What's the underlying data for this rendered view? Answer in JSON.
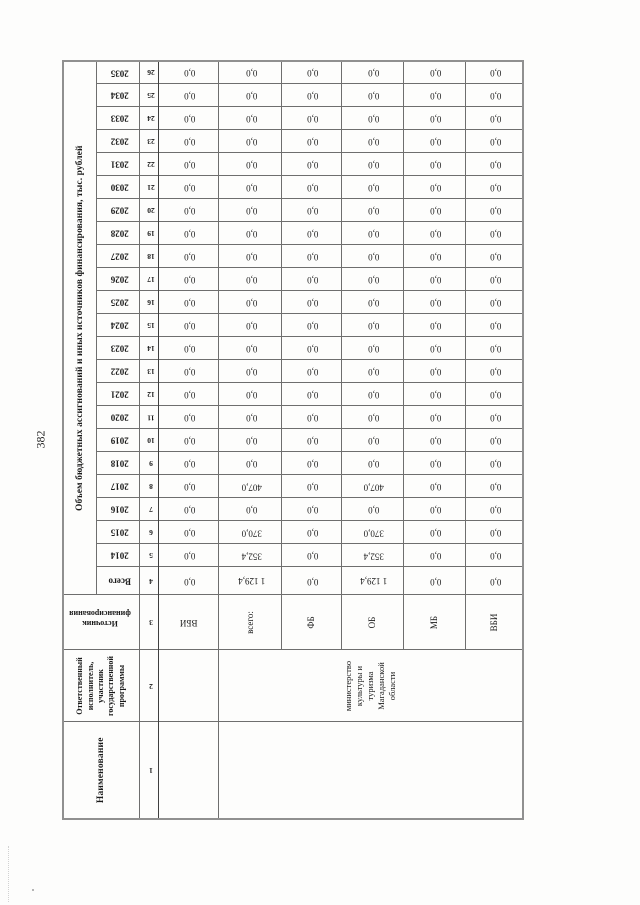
{
  "page": {
    "number": "382"
  },
  "table": {
    "headers": {
      "col1": "Наименование",
      "col2": "Ответственный\nисполнитель,\nучастник\nгосударственной\nпрограммы",
      "col3": "Источник\nфинансирования",
      "amount_span": "Объем бюджетных ассигнований и иных источников финансирования, тыс. рублей",
      "total": "Всего",
      "years": [
        "2014",
        "2015",
        "2016",
        "2017",
        "2018",
        "2019",
        "2020",
        "2021",
        "2022",
        "2023",
        "2024",
        "2025",
        "2026",
        "2027",
        "2028",
        "2029",
        "2030",
        "2031",
        "2032",
        "2033",
        "2034",
        "2035"
      ],
      "numbers": [
        "1",
        "2",
        "3",
        "4",
        "5",
        "6",
        "7",
        "8",
        "9",
        "10",
        "11",
        "12",
        "13",
        "14",
        "15",
        "16",
        "17",
        "18",
        "19",
        "20",
        "21",
        "22",
        "23",
        "24",
        "25",
        "26"
      ]
    },
    "groups": [
      {
        "name": "",
        "executor": "",
        "rows": [
          {
            "source": "ВБИ",
            "source_rotated": true,
            "total": "0,0",
            "values": [
              "0,0",
              "0,0",
              "0,0",
              "0,0",
              "0,0",
              "0,0",
              "0,0",
              "0,0",
              "0,0",
              "0,0",
              "0,0",
              "0,0",
              "0,0",
              "0,0",
              "0,0",
              "0,0",
              "0,0",
              "0,0",
              "0,0",
              "0,0",
              "0,0",
              "0,0"
            ]
          }
        ]
      },
      {
        "name": "",
        "executor": "министерство\nкультуры и\nтуризма\nМагаданской\nобласти",
        "rows": [
          {
            "source": "всего:",
            "source_rotated": false,
            "total": "1 129,4",
            "values": [
              "352,4",
              "370,0",
              "0,0",
              "407,0",
              "0,0",
              "0,0",
              "0,0",
              "0,0",
              "0,0",
              "0,0",
              "0,0",
              "0,0",
              "0,0",
              "0,0",
              "0,0",
              "0,0",
              "0,0",
              "0,0",
              "0,0",
              "0,0",
              "0,0",
              "0,0"
            ]
          },
          {
            "source": "ФБ",
            "source_rotated": false,
            "total": "0,0",
            "values": [
              "0,0",
              "0,0",
              "0,0",
              "0,0",
              "0,0",
              "0,0",
              "0,0",
              "0,0",
              "0,0",
              "0,0",
              "0,0",
              "0,0",
              "0,0",
              "0,0",
              "0,0",
              "0,0",
              "0,0",
              "0,0",
              "0,0",
              "0,0",
              "0,0",
              "0,0"
            ]
          },
          {
            "source": "ОБ",
            "source_rotated": false,
            "total": "1 129,4",
            "values": [
              "352,4",
              "370,0",
              "0,0",
              "407,0",
              "0,0",
              "0,0",
              "0,0",
              "0,0",
              "0,0",
              "0,0",
              "0,0",
              "0,0",
              "0,0",
              "0,0",
              "0,0",
              "0,0",
              "0,0",
              "0,0",
              "0,0",
              "0,0",
              "0,0",
              "0,0"
            ]
          },
          {
            "source": "МБ",
            "source_rotated": false,
            "total": "0,0",
            "values": [
              "0,0",
              "0,0",
              "0,0",
              "0,0",
              "0,0",
              "0,0",
              "0,0",
              "0,0",
              "0,0",
              "0,0",
              "0,0",
              "0,0",
              "0,0",
              "0,0",
              "0,0",
              "0,0",
              "0,0",
              "0,0",
              "0,0",
              "0,0",
              "0,0",
              "0,0"
            ]
          },
          {
            "source": "ВБИ",
            "source_rotated": false,
            "total": "0,0",
            "values": [
              "0,0",
              "0,0",
              "0,0",
              "0,0",
              "0,0",
              "0,0",
              "0,0",
              "0,0",
              "0,0",
              "0,0",
              "0,0",
              "0,0",
              "0,0",
              "0,0",
              "0,0",
              "0,0",
              "0,0",
              "0,0",
              "0,0",
              "0,0",
              "0,0",
              "0,0"
            ]
          }
        ]
      }
    ],
    "layout": {
      "col_widths": [
        97,
        72,
        55,
        28
      ],
      "year_col_width": 23,
      "header_row_heights": [
        33,
        43,
        17
      ],
      "data_row_heights": [
        60,
        63,
        60,
        62,
        62,
        58
      ]
    }
  }
}
